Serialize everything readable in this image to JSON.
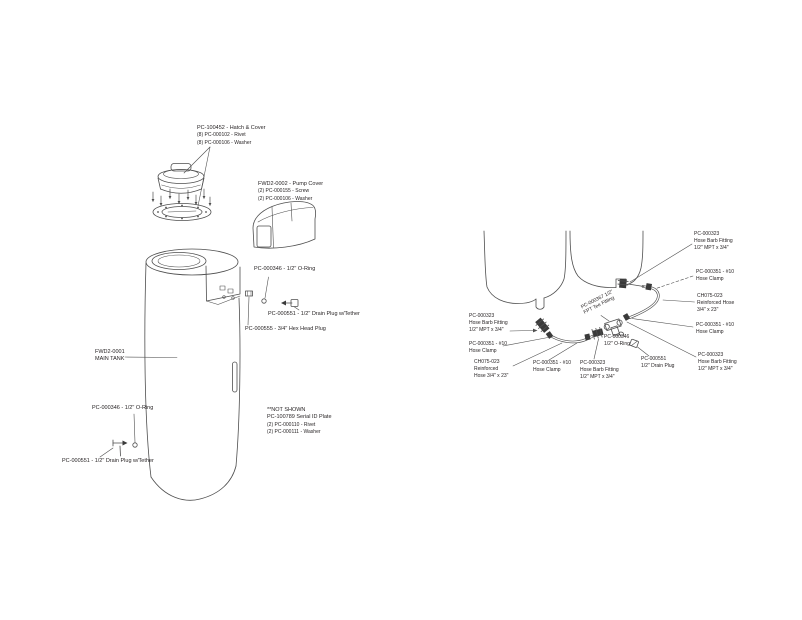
{
  "page": {
    "type": "parts-diagram",
    "background": "#ffffff",
    "colors": {
      "line": "#4f4f4f",
      "fitting_fill": "#3a3a3a",
      "text": "#231f20"
    }
  },
  "left_diagram": {
    "name": "main-tank-exploded-view",
    "labels": {
      "hatch_cover": {
        "lines": [
          "PC-100452 - Hatch & Cover",
          "(8) PC-000102 - Rivet",
          "(8) PC-000106 - Washer"
        ]
      },
      "pump_cover": {
        "lines": [
          "FWD2-0002 - Pump Cover",
          "(2) PC-000155 - Screw",
          "(2) PC-000106 - Washer"
        ]
      },
      "oring_top": {
        "lines": [
          "PC-000346 - 1/2\" O-Ring"
        ]
      },
      "drain_plug_top": {
        "lines": [
          "PC-000551 - 1/2\" Drain Plug w/Tether"
        ]
      },
      "hex_plug": {
        "lines": [
          "PC-000555 - 3/4\" Hex Head Plug"
        ]
      },
      "main_tank": {
        "lines": [
          "FWD2-0001",
          "MAIN TANK"
        ]
      },
      "oring_side": {
        "lines": [
          "PC-000346 - 1/2\" O-Ring"
        ]
      },
      "drain_plug_side": {
        "lines": [
          "PC-000551 - 1/2\" Drain Plug w/Tether"
        ]
      },
      "not_shown": {
        "lines": [
          "**NOT SHOWN",
          "PC-100789 Serial ID Plate",
          "(2) PC-000110 - Rivet",
          "(2) PC-000111 - Washer"
        ]
      }
    }
  },
  "right_diagram": {
    "name": "hose-kit-assembly-view",
    "labels": {
      "barb_left": {
        "lines": [
          "PC-000323",
          "Hose Barb Fitting",
          "1/2\" MPT x 3/4\""
        ]
      },
      "clamp_left": {
        "lines": [
          "PC-000351 - #10",
          "Hose Clamp"
        ]
      },
      "hose_left": {
        "lines": [
          "CH075-023",
          "Reinforced",
          "Hose 3/4\" x 23\""
        ]
      },
      "clamp_mid": {
        "lines": [
          "PC-000351 - #10",
          "Hose Clamp"
        ]
      },
      "barb_mid": {
        "lines": [
          "PC-000323",
          "Hose Barb Fitting",
          "1/2\" MPT x 3/4\""
        ]
      },
      "oring_mid": {
        "lines": [
          "PC-000346",
          "1/2\" O-Ring"
        ]
      },
      "tee_fitting": {
        "lines": [
          "PC-000367 1/2\"",
          "FPT Tee Fitting"
        ]
      },
      "drain_plug": {
        "lines": [
          "PC-000551",
          "1/2\" Drain Plug"
        ]
      },
      "barb_top_right": {
        "lines": [
          "PC-000323",
          "Hose Barb Fitting",
          "1/2\" MPT x 3/4\""
        ]
      },
      "clamp_top_right": {
        "lines": [
          "PC-000351 - #10",
          "Hose Clamp"
        ]
      },
      "hose_right": {
        "lines": [
          "CH075-023",
          "Reinforced Hose",
          "3/4\" x 23\""
        ]
      },
      "clamp_right": {
        "lines": [
          "PC-000351 - #10",
          "Hose Clamp"
        ]
      },
      "barb_bottom_right": {
        "lines": [
          "PC-000323",
          "Hose Barb Fitting",
          "1/2\" MPT x 3/4\""
        ]
      }
    }
  }
}
